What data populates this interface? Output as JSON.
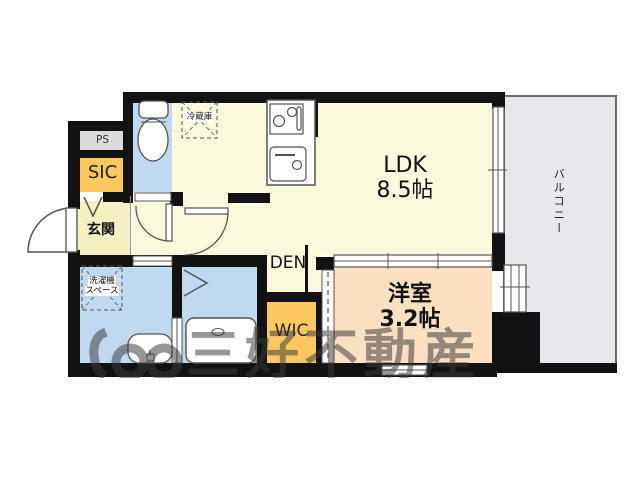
{
  "floor_plan": {
    "rooms": {
      "ldk": {
        "name": "LDK",
        "size": "8.5帖"
      },
      "western_room": {
        "name": "洋室",
        "size": "3.2帖"
      },
      "balcony": {
        "name": "バルコニー"
      },
      "entrance": {
        "name": "玄関"
      },
      "shoe_closet": {
        "name": "SIC"
      },
      "pipe_space": {
        "name": "PS"
      },
      "walk_in_closet": {
        "name": "WIC"
      },
      "den": {
        "name": "DEN"
      }
    },
    "fixtures": {
      "refrigerator": {
        "label": "冷蔵庫"
      },
      "washing_machine_space": {
        "label_line1": "洗濯機",
        "label_line2": "スペース"
      }
    }
  },
  "watermark": {
    "company": "三好不動産"
  },
  "colors": {
    "wall": "#121212",
    "cream": "#FBF9DC",
    "genkan": "#F4F0C2",
    "water": "#BFD9F1",
    "orange": "#FAC85F",
    "peach": "#FADFC0",
    "psgray": "#DBDBDB",
    "balcony": "#E8E7EB",
    "stroke": "#555555",
    "wm": "#3A3A3A"
  }
}
